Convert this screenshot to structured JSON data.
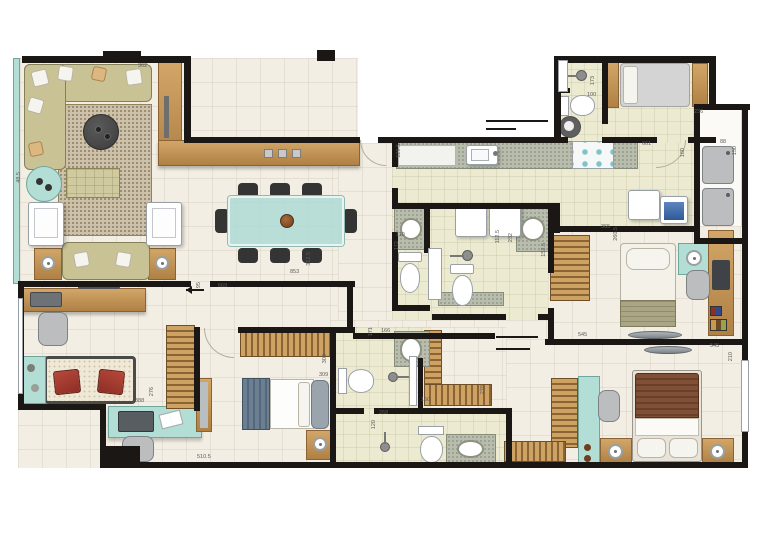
{
  "plan": {
    "type": "apartment-floor-plan",
    "palette": {
      "wall": "#1b1714",
      "floor_beige": "#f3eee4",
      "floor_bath": "#ecebd2",
      "granite": "#b9bdae",
      "teal": "#b2ded6",
      "sofa_olive": "#c9c295",
      "wood": "#c09355",
      "bed_brown": "#7b4b33",
      "bed_blue": "#6b7f93",
      "accent_red": "#a83a30"
    },
    "labels": [
      {
        "text": "362",
        "x": 138,
        "y": 63
      },
      {
        "text": "48.5",
        "x": 16,
        "y": 172,
        "v": 1
      },
      {
        "text": "853",
        "x": 290,
        "y": 269
      },
      {
        "text": "312.5",
        "x": 306,
        "y": 252,
        "v": 1
      },
      {
        "text": "95",
        "x": 196,
        "y": 282,
        "v": 1
      },
      {
        "text": "669",
        "x": 218,
        "y": 283
      },
      {
        "text": "129.5",
        "x": 396,
        "y": 144,
        "v": 1
      },
      {
        "text": "173",
        "x": 590,
        "y": 76,
        "v": 1
      },
      {
        "text": "100",
        "x": 587,
        "y": 92
      },
      {
        "text": "236",
        "x": 694,
        "y": 109
      },
      {
        "text": "661",
        "x": 642,
        "y": 141
      },
      {
        "text": "180",
        "x": 680,
        "y": 148,
        "v": 1
      },
      {
        "text": "88",
        "x": 720,
        "y": 139
      },
      {
        "text": "150",
        "x": 732,
        "y": 146,
        "v": 1
      },
      {
        "text": "110",
        "x": 396,
        "y": 232
      },
      {
        "text": "172",
        "x": 394,
        "y": 241,
        "v": 1
      },
      {
        "text": "112.5",
        "x": 495,
        "y": 230,
        "v": 1
      },
      {
        "text": "232",
        "x": 508,
        "y": 233,
        "v": 1
      },
      {
        "text": "152.5",
        "x": 541,
        "y": 243,
        "v": 1
      },
      {
        "text": "365",
        "x": 601,
        "y": 224
      },
      {
        "text": "260.5",
        "x": 613,
        "y": 227,
        "v": 1
      },
      {
        "text": "545",
        "x": 578,
        "y": 332
      },
      {
        "text": "545",
        "x": 710,
        "y": 343
      },
      {
        "text": "210",
        "x": 728,
        "y": 352,
        "v": 1
      },
      {
        "text": "388",
        "x": 135,
        "y": 398
      },
      {
        "text": "276",
        "x": 149,
        "y": 387,
        "v": 1
      },
      {
        "text": "510.5",
        "x": 197,
        "y": 454
      },
      {
        "text": "303",
        "x": 322,
        "y": 354,
        "v": 1
      },
      {
        "text": "309",
        "x": 319,
        "y": 372
      },
      {
        "text": "150",
        "x": 421,
        "y": 397
      },
      {
        "text": "278",
        "x": 480,
        "y": 385,
        "v": 1
      },
      {
        "text": "166",
        "x": 381,
        "y": 328
      },
      {
        "text": "171",
        "x": 368,
        "y": 327,
        "v": 1
      },
      {
        "text": "268",
        "x": 379,
        "y": 410
      },
      {
        "text": "120",
        "x": 371,
        "y": 420,
        "v": 1
      }
    ]
  }
}
